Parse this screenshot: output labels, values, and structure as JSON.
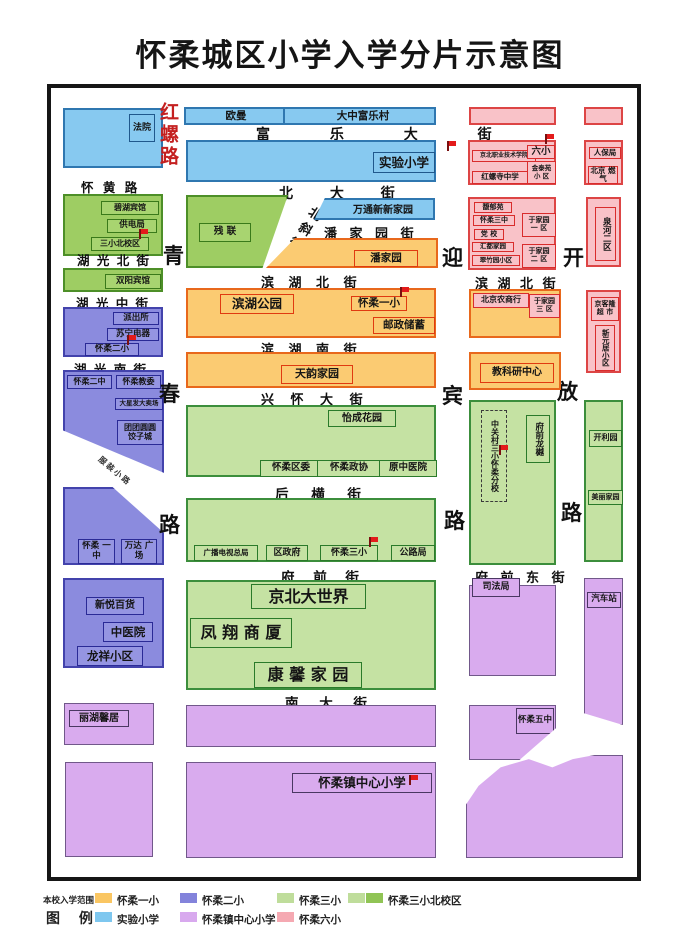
{
  "title": "怀柔城区小学入学分片示意图",
  "roads": {
    "hongluo": "红螺路",
    "qingchun": [
      "青",
      "春",
      "路"
    ],
    "yingbin": [
      "迎",
      "宾",
      "路"
    ],
    "kaifang": [
      "开",
      "放",
      "路"
    ],
    "huaihuang": "怀 黄 路",
    "fule": "富 乐 大 街",
    "beida": "北 大 街",
    "hg_north": "湖 光 北 街",
    "hg_mid": "湖 光 中 街",
    "hg_south": "湖 光 南 街",
    "beixie": "北斜街",
    "pjy_st": "潘 家 园 街",
    "bh_north1": "滨 湖 北 街",
    "bh_north2": "滨 湖 北 街",
    "bh_south": "滨 湖 南 街",
    "xinghuai": "兴 怀 大 街",
    "houheng": "后 横 街",
    "fuqian": "府 前 街",
    "fuqian_e": "府 前 东 街",
    "nanda": "南 大 街",
    "lane": "服装小路"
  },
  "blocks": {
    "fayuan": "法院",
    "bihu": "碧湖宾馆",
    "gongdian": "供电局",
    "sanxiao_bei": "三小北校区",
    "shuangyang": "双阳宾馆",
    "paichusuo": "派出所",
    "suning": "苏宁电器",
    "erxiao": "怀柔二小",
    "erzhong": "怀柔二中",
    "jiaowei": "怀柔教委",
    "daxingfa": "大星发大卖场",
    "tuantuan": "团团圆圆 饺子城",
    "yizhong": "怀柔 一中",
    "wanda": "万达 广场",
    "xinyue": "新悦百货",
    "zhongyiyuan": "中医院",
    "longxiang": "龙祥小区",
    "lihu": "丽湖馨居",
    "ouman": "欧曼",
    "dazhong": "大中富乐村",
    "shiyan": "实验小学",
    "canlian": "残 联",
    "wantong": "万通新新家园",
    "panjiayuan": "潘家园",
    "binhupark": "滨湖公园",
    "yixiao": "怀柔一小",
    "youzheng": "邮政储蓄",
    "tianyun": "天韵家园",
    "yicheng": "怡成花园",
    "quwei": "怀柔区委",
    "zhengxie": "怀柔政协",
    "yuanzhongyi": "原中医院",
    "guangbo": "广播电视总局",
    "quzhengfu": "区政府",
    "sanxiao": "怀柔三小",
    "gongluju": "公路局",
    "jingbeidsj": "京北大世界",
    "fengxiang": "凤 翔 商 厦",
    "kangxin": "康 馨 家 园",
    "centerschool": "怀柔镇中心小学",
    "jbcollege": "京北职业技术学院",
    "liuxiao": "六小",
    "jintai": "金泰苑 小 区",
    "hongluosi": "红螺寺中学",
    "renbao": "人保局",
    "ranqi": "北京 燃气",
    "fuyuyuan": "馥郁苑",
    "sanzhong": "怀柔三中",
    "dangxiao": "党 校",
    "huidu": "汇都家园",
    "cuizhu": "翠竹园小区",
    "yjy1": "于家园 一 区",
    "yjy2": "于家园 二 区",
    "yjy3": "于家园 三 区",
    "quanhe": "泉河二区",
    "jingkelong": "京客隆 超 市",
    "xinyuanju": "新元居小区",
    "nongshang": "北京农商行",
    "jiaokeyan": "教科研中心",
    "zgc": "中关村三小怀柔分校",
    "longyue": "府前龙樾",
    "kailiyuan": "开利园",
    "meili": "美丽家园",
    "sifaju": "司法局",
    "qichezhan": "汽车站",
    "wuzhong": "怀柔五中"
  },
  "legend": {
    "scope_label": "本校入学范围",
    "title": "图 例",
    "items": [
      {
        "label": "怀柔一小",
        "color": "#FAC662"
      },
      {
        "label": "怀柔二小",
        "color": "#8383DB"
      },
      {
        "label": "怀柔三小",
        "color": "#BFDD9B"
      },
      {
        "label": "怀柔三小北校区",
        "color": "#BFDD9B",
        "color2": "#90C455"
      },
      {
        "label": "实验小学",
        "color": "#7EC7EF"
      },
      {
        "label": "怀柔镇中心小学",
        "color": "#D8A9EE"
      },
      {
        "label": "怀柔六小",
        "color": "#F5A9B2"
      }
    ]
  }
}
